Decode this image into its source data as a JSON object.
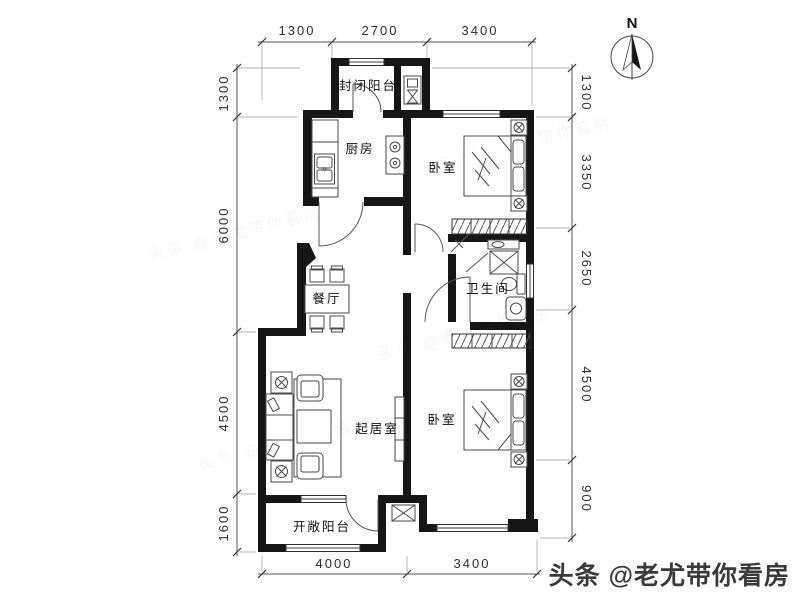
{
  "plan": {
    "rooms": {
      "enclosed_balcony": "封闭阳台",
      "kitchen": "厨房",
      "bedroom_north": "卧室",
      "dining": "餐厅",
      "bathroom": "卫生间",
      "living": "起居室",
      "bedroom_south": "卧室",
      "open_balcony": "开敞阳台"
    },
    "dimensions": {
      "top": [
        "1300",
        "2700",
        "3400"
      ],
      "bottom": [
        "4000",
        "3400"
      ],
      "left": [
        "1300",
        "6000",
        "4500",
        "1600"
      ],
      "right": [
        "1300",
        "3350",
        "2650",
        "4500",
        "900"
      ]
    },
    "compass": {
      "north": "N"
    }
  },
  "watermark": {
    "text": "头条 @老尤带你看房"
  },
  "colors": {
    "wall": "#161616",
    "furniture_line": "#4a4a4a",
    "dim_text": "#2f2f2f",
    "background": "#ffffff",
    "watermark_text": "#3a3a3a"
  }
}
